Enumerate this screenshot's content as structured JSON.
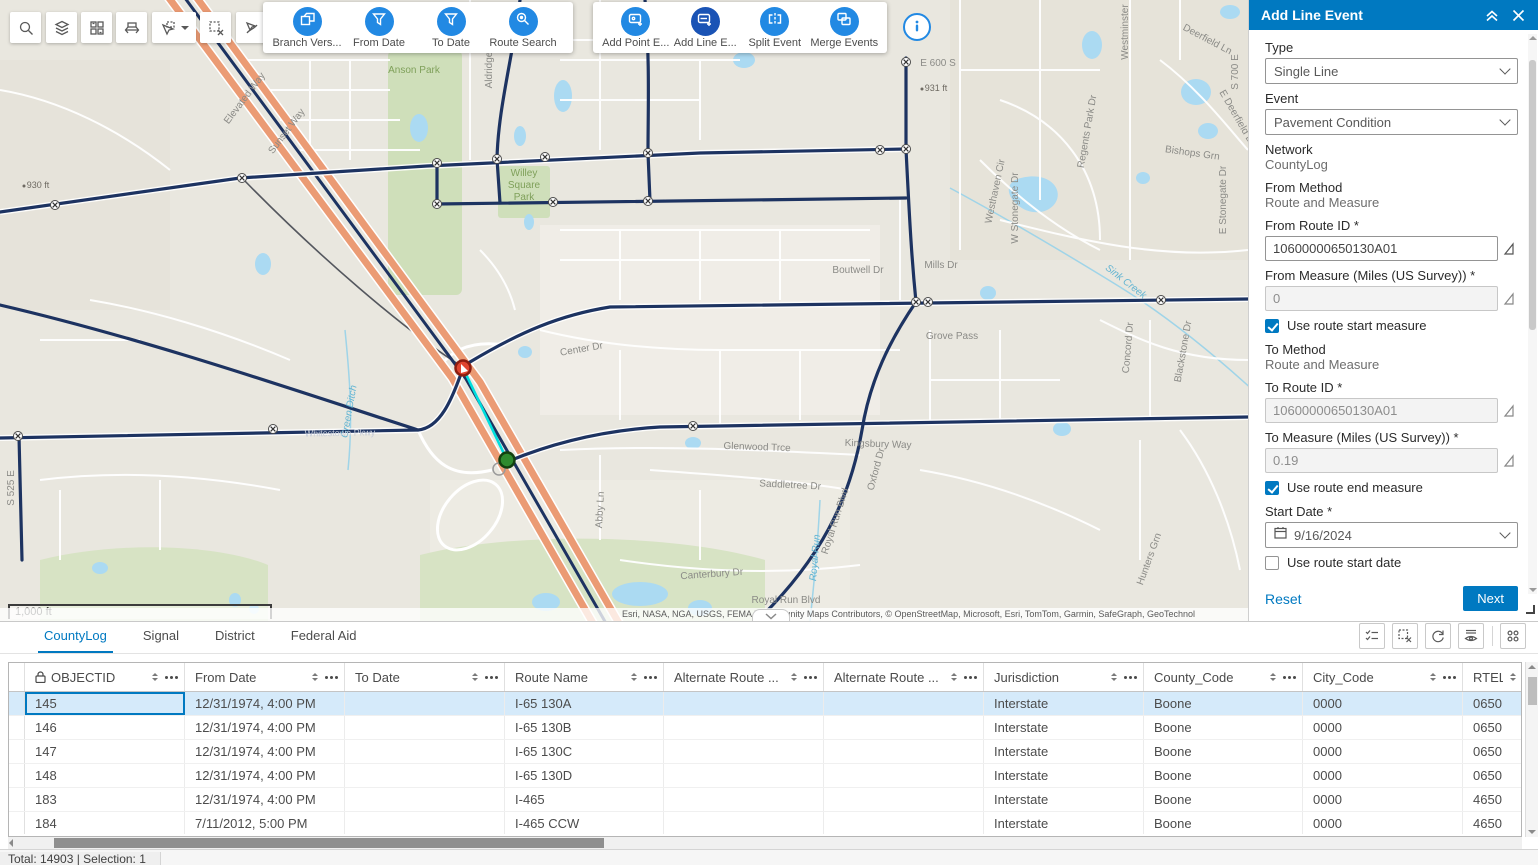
{
  "colors": {
    "accent": "#0079c1",
    "toolbar_icon_blue": "#2289e3",
    "selected_tool_blue": "#1a53b5",
    "selected_row": "#d5eafa",
    "highway_orange": "#eb9b74",
    "route_navy": "#1d3361",
    "selection_cyan": "#00dede"
  },
  "toolbar": {
    "map_tools": [
      "search-icon",
      "layers-icon",
      "basemap-grid-icon",
      "measure-icon",
      "select-pointer-icon",
      "clear-selection-icon",
      "route-select-icon"
    ],
    "group1": {
      "items": [
        {
          "label": "Branch Vers...",
          "icon": "branch-version-icon"
        },
        {
          "label": "From Date",
          "icon": "funnel-icon"
        },
        {
          "label": "To Date",
          "icon": "funnel-icon"
        },
        {
          "label": "Route Search",
          "icon": "route-search-icon"
        }
      ]
    },
    "group2": {
      "items": [
        {
          "label": "Add Point E...",
          "icon": "add-point-event-icon",
          "selected": false
        },
        {
          "label": "Add Line E...",
          "icon": "add-line-event-icon",
          "selected": true
        },
        {
          "label": "Split Event",
          "icon": "split-event-icon",
          "selected": false
        },
        {
          "label": "Merge Events",
          "icon": "merge-events-icon",
          "selected": false
        }
      ]
    },
    "info_icon": "info-icon"
  },
  "map": {
    "scale_bar": "1,000 ft",
    "attribution": "Esri, NASA, NGA, USGS, FEMA | Community Maps Contributors, © OpenStreetMap, Microsoft, Esri, TomTom, Garmin, SafeGraph, GeoTechnol",
    "labels": [
      {
        "t": "Elevated Way",
        "x": 247,
        "y": 100,
        "r": -53,
        "c": "road"
      },
      {
        "t": "Sunset Way",
        "x": 289,
        "y": 133,
        "r": -53,
        "c": "road"
      },
      {
        "t": "Anson Park",
        "x": 414,
        "y": 73,
        "r": 0,
        "c": "park"
      },
      {
        "t": "Aldridge",
        "x": 492,
        "y": 70,
        "r": -90,
        "c": "road"
      },
      {
        "t": "Willey",
        "x": 524,
        "y": 176,
        "r": 0,
        "c": "park"
      },
      {
        "t": "Square",
        "x": 524,
        "y": 188,
        "r": 0,
        "c": "park"
      },
      {
        "t": "Park",
        "x": 524,
        "y": 200,
        "r": 0,
        "c": "park"
      },
      {
        "t": "E 600 S",
        "x": 938,
        "y": 66,
        "r": 0,
        "c": "road"
      },
      {
        "t": "931 ft",
        "x": 936,
        "y": 91,
        "r": 0,
        "c": "elev"
      },
      {
        "t": "930 ft",
        "x": 38,
        "y": 188,
        "r": 0,
        "c": "elev"
      },
      {
        "t": "Westminster",
        "x": 1128,
        "y": 32,
        "r": -90,
        "c": "road"
      },
      {
        "t": "Deerfield Ln",
        "x": 1206,
        "y": 42,
        "r": 28,
        "c": "road"
      },
      {
        "t": "S 700 E",
        "x": 1238,
        "y": 72,
        "r": -90,
        "c": "road"
      },
      {
        "t": "E Deerfield D",
        "x": 1234,
        "y": 118,
        "r": 60,
        "c": "road"
      },
      {
        "t": "Regents Park Dr",
        "x": 1090,
        "y": 132,
        "r": -80,
        "c": "road"
      },
      {
        "t": "Bishops Grn",
        "x": 1192,
        "y": 156,
        "r": 8,
        "c": "road"
      },
      {
        "t": "Westhaven Cir",
        "x": 998,
        "y": 192,
        "r": -78,
        "c": "road"
      },
      {
        "t": "W Stonegate Dr",
        "x": 1018,
        "y": 208,
        "r": -90,
        "c": "road"
      },
      {
        "t": "E Stonegate Dr",
        "x": 1226,
        "y": 200,
        "r": -90,
        "c": "road"
      },
      {
        "t": "Mills Dr",
        "x": 941,
        "y": 268,
        "r": 0,
        "c": "road"
      },
      {
        "t": "Boutwell Dr",
        "x": 858,
        "y": 273,
        "r": 0,
        "c": "road"
      },
      {
        "t": "Sink Creek",
        "x": 1124,
        "y": 284,
        "r": 38,
        "c": "water"
      },
      {
        "t": "Concord Dr",
        "x": 1131,
        "y": 348,
        "r": -85,
        "c": "road"
      },
      {
        "t": "Blackstone Dr",
        "x": 1186,
        "y": 352,
        "r": -80,
        "c": "road"
      },
      {
        "t": "Grove Pass",
        "x": 952,
        "y": 339,
        "r": 0,
        "c": "road"
      },
      {
        "t": "Center Dr",
        "x": 582,
        "y": 352,
        "r": -10,
        "c": "road"
      },
      {
        "t": "Green Ditch",
        "x": 352,
        "y": 412,
        "r": -80,
        "c": "water"
      },
      {
        "t": "Whitestown Pkwy",
        "x": 340,
        "y": 436,
        "r": -1,
        "c": "onroad"
      },
      {
        "t": "S 525 E",
        "x": 14,
        "y": 488,
        "r": -90,
        "c": "road"
      },
      {
        "t": "Kingsbury Way",
        "x": 878,
        "y": 447,
        "r": 2,
        "c": "road"
      },
      {
        "t": "Glenwood Trce",
        "x": 757,
        "y": 450,
        "r": 2,
        "c": "road"
      },
      {
        "t": "Saddletree Dr",
        "x": 790,
        "y": 488,
        "r": 3,
        "c": "road"
      },
      {
        "t": "Abby Ln",
        "x": 603,
        "y": 510,
        "r": -87,
        "c": "road"
      },
      {
        "t": "Oxford Dr",
        "x": 879,
        "y": 470,
        "r": -75,
        "c": "road"
      },
      {
        "t": "Royal Run Blvd",
        "x": 838,
        "y": 522,
        "r": -72,
        "c": "road"
      },
      {
        "t": "Royal Run",
        "x": 818,
        "y": 558,
        "r": -85,
        "c": "water"
      },
      {
        "t": "Hunters Grn",
        "x": 1152,
        "y": 560,
        "r": -70,
        "c": "road"
      },
      {
        "t": "Canterbury Dr",
        "x": 712,
        "y": 577,
        "r": -4,
        "c": "road"
      },
      {
        "t": "Royal Run Blvd",
        "x": 786,
        "y": 603,
        "r": 0,
        "c": "road"
      }
    ]
  },
  "panel": {
    "title": "Add Line Event",
    "type_label": "Type",
    "type_value": "Single Line",
    "event_label": "Event",
    "event_value": "Pavement Condition",
    "network_label": "Network",
    "network_value": "CountyLog",
    "from_method_label": "From Method",
    "from_method_value": "Route and Measure",
    "from_route_label": "From Route ID *",
    "from_route_value": "10600000650130A01",
    "from_measure_label": "From Measure (Miles (US Survey)) *",
    "from_measure_value": "0",
    "use_route_start_measure": "Use route start measure",
    "use_route_start_measure_checked": true,
    "to_method_label": "To Method",
    "to_method_value": "Route and Measure",
    "to_route_label": "To Route ID *",
    "to_route_value": "10600000650130A01",
    "to_measure_label": "To Measure (Miles (US Survey)) *",
    "to_measure_value": "0.19",
    "use_route_end_measure": "Use route end measure",
    "use_route_end_measure_checked": true,
    "start_date_label": "Start Date *",
    "start_date_value": "9/16/2024",
    "use_route_start_date": "Use route start date",
    "use_route_start_date_checked": false,
    "end_date_label": "End Date",
    "end_date_placeholder": "MM/DD/YYYY",
    "use_route_end_date": "Use route end date",
    "use_route_end_date_checked": false,
    "reset": "Reset",
    "next": "Next"
  },
  "table": {
    "tabs": [
      "CountyLog",
      "Signal",
      "District",
      "Federal Aid"
    ],
    "active_tab": 0,
    "columns": [
      {
        "label": "OBJECTID",
        "lock": true
      },
      {
        "label": "From Date"
      },
      {
        "label": "To Date"
      },
      {
        "label": "Route Name"
      },
      {
        "label": "Alternate Route ..."
      },
      {
        "label": "Alternate Route ..."
      },
      {
        "label": "Jurisdiction"
      },
      {
        "label": "County_Code"
      },
      {
        "label": "City_Code"
      },
      {
        "label": "RTEL"
      }
    ],
    "rows": [
      [
        "145",
        "12/31/1974, 4:00 PM",
        "",
        "I-65 130A",
        "",
        "",
        "Interstate",
        "Boone",
        "0000",
        "0650"
      ],
      [
        "146",
        "12/31/1974, 4:00 PM",
        "",
        "I-65 130B",
        "",
        "",
        "Interstate",
        "Boone",
        "0000",
        "0650"
      ],
      [
        "147",
        "12/31/1974, 4:00 PM",
        "",
        "I-65 130C",
        "",
        "",
        "Interstate",
        "Boone",
        "0000",
        "0650"
      ],
      [
        "148",
        "12/31/1974, 4:00 PM",
        "",
        "I-65 130D",
        "",
        "",
        "Interstate",
        "Boone",
        "0000",
        "0650"
      ],
      [
        "183",
        "12/31/1974, 4:00 PM",
        "",
        "I-465",
        "",
        "",
        "Interstate",
        "Boone",
        "0000",
        "4650"
      ],
      [
        "184",
        "7/11/2012, 5:00 PM",
        "",
        "I-465 CCW",
        "",
        "",
        "Interstate",
        "Boone",
        "0000",
        "4650"
      ]
    ],
    "selected_row": 0,
    "status": "Total: 14903 | Selection: 1"
  }
}
